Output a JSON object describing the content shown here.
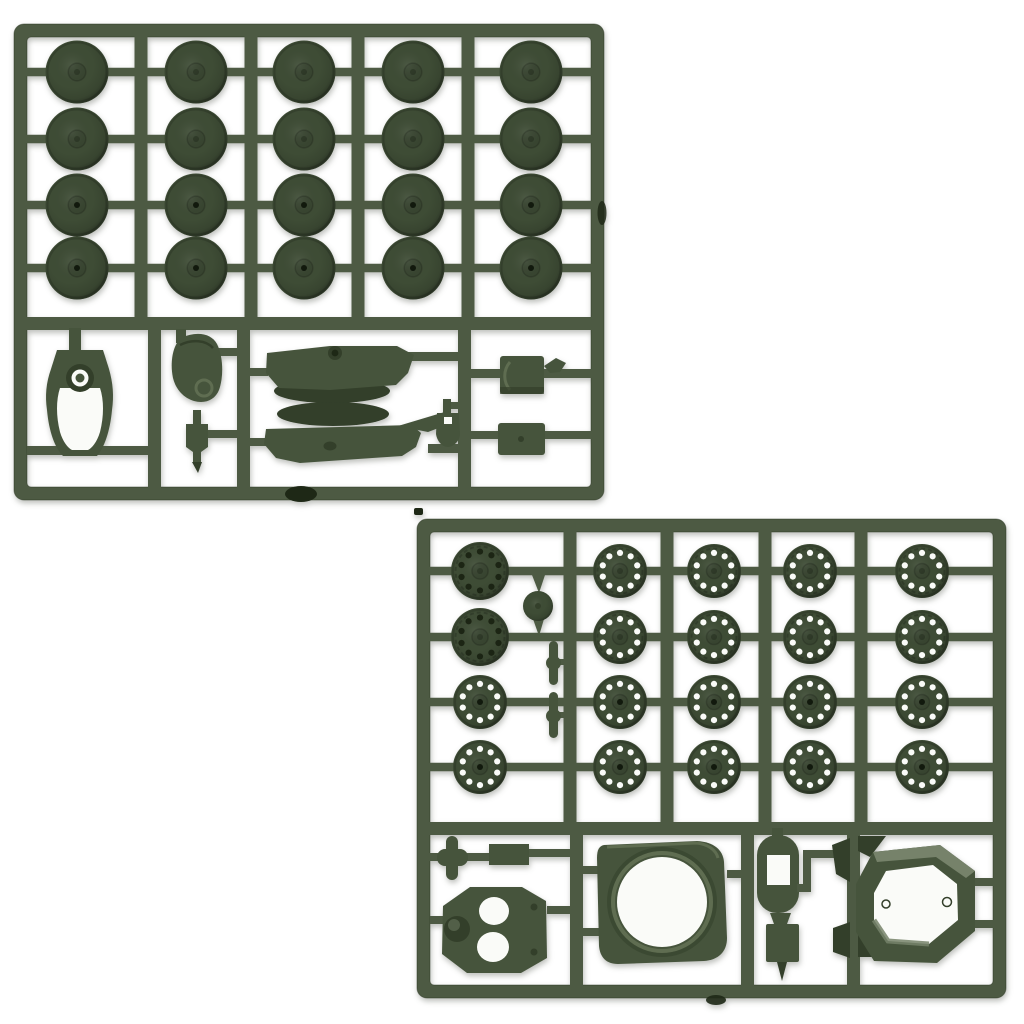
{
  "image": {
    "type": "product-photo",
    "subject": "Two dark olive-green injection-molded plastic model kit sprues with tank parts on a plain white background",
    "background": "#ffffff"
  },
  "palette": {
    "background": "#ffffff",
    "plastic_base": "#4d5a43",
    "plastic_dark": "#3e4c35",
    "plastic_part": "#46543c",
    "plastic_darker": "#333f2a",
    "plastic_light": "#5f6d51",
    "plastic_highlight": "#76826a",
    "outline": "#283320",
    "hole_white": "#fafbf8",
    "mark_dark": "#1e2816"
  },
  "sprues": [
    {
      "name": "sprue-a",
      "position": "top-left",
      "description": "Sprue A: 20 smooth road wheels in a 4x5 grid, plus gun mantlet, hatch, bracket, turret shell halves, shovel and two stowage boxes",
      "frame": {
        "x": 14,
        "y": 24,
        "w": 590,
        "h": 476,
        "bar": 13,
        "radius": 10
      },
      "grid": {
        "col_centers": [
          77,
          196,
          304,
          413,
          531
        ],
        "row_centers": [
          72,
          139,
          205,
          268
        ],
        "divider_centers": [
          141,
          251,
          358,
          468
        ],
        "separator_y": 317
      },
      "bottom_divider_centers": [
        154.5,
        243.5,
        464.5
      ],
      "wheels": {
        "style": "smooth",
        "count": 20,
        "radius": 31.5,
        "part_name": "road-wheel"
      },
      "parts": [
        "road wheel x20",
        "gun mantlet",
        "hatch cover",
        "small bracket",
        "turret shell upper half",
        "turret shell lower half",
        "shovel",
        "stowage box x2"
      ]
    },
    {
      "name": "sprue-b",
      "position": "bottom-right",
      "description": "Sprue B: 20 perforated wheels in a 4x5 grid, plus idler disc, axle rods, cross fitting, block, turret roof with hatch holes, turret ring, fuel tank, funnel block, fender wedges and hexagonal hull frame",
      "frame": {
        "x": 417,
        "y": 519,
        "w": 589,
        "h": 479,
        "bar": 13,
        "radius": 10
      },
      "grid": {
        "col_centers": [
          480,
          620,
          714,
          810,
          922
        ],
        "row_centers": [
          571,
          637,
          702,
          767
        ],
        "divider_centers": [
          570,
          667,
          765,
          861
        ],
        "separator_y": 822
      },
      "bottom_divider_centers": [
        576.5,
        747.5,
        853.5
      ],
      "wheels": {
        "style": "perforated",
        "count": 20,
        "radius": 27,
        "hole_count": 10,
        "hole_radius": 3.1,
        "hole_ring_ratio": 0.67,
        "part_name": "perforated-wheel",
        "special": {
          "cols": [
            0
          ],
          "rows": [
            0,
            1
          ],
          "radius": 29,
          "hole_fill": "dark"
        }
      },
      "parts": [
        "perforated wheel x20",
        "idler disc",
        "axle rod x2",
        "cross fitting",
        "rectangular block",
        "turret roof with two hatch openings",
        "turret ring",
        "fuel tank",
        "funnel block",
        "fender wedge x4",
        "hexagonal hull frame"
      ]
    }
  ]
}
